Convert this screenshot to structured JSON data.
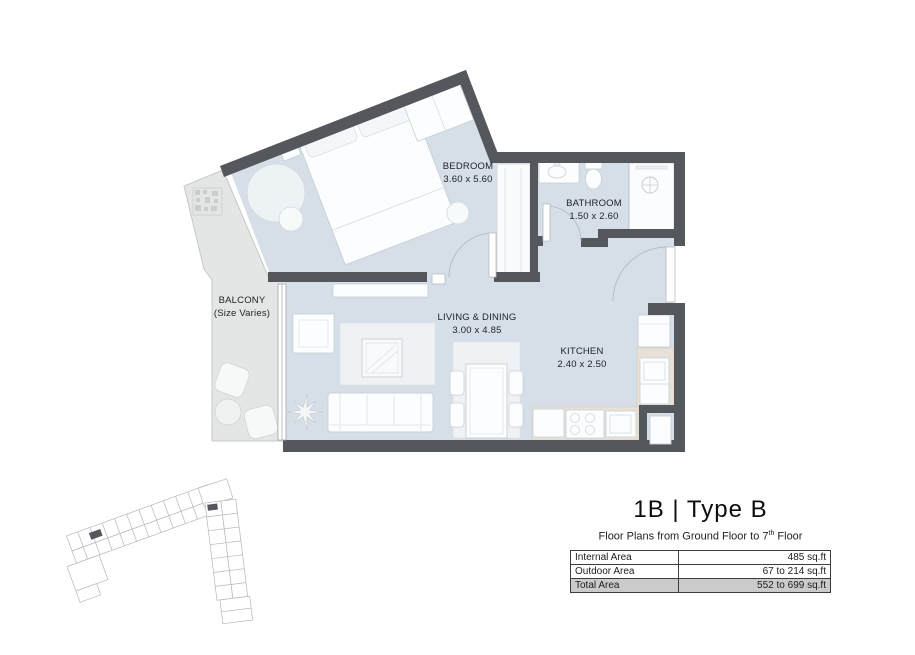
{
  "plan": {
    "rooms": {
      "bedroom": {
        "name": "BEDROOM",
        "dims": "3.60 x 5.60"
      },
      "bathroom": {
        "name": "BATHROOM",
        "dims": "1.50 x 2.60"
      },
      "living_dining": {
        "name": "LIVING & DINING",
        "dims": "3.00 x 4.85"
      },
      "kitchen": {
        "name": "KITCHEN",
        "dims": "2.40 x 2.50"
      },
      "balcony": {
        "name": "BALCONY",
        "dims": "(Size Varies)"
      }
    },
    "colors": {
      "wall": "#54575b",
      "floor": "#d6dfe7",
      "balcony": "#e4e5e5",
      "counter": "#e9e1d8",
      "furniture": "#fbfdfe",
      "total_row": "#cbcbcb"
    }
  },
  "title_block": {
    "title": "1B | Type B",
    "subtitle": {
      "prefix": "Floor Plans from Ground Floor to 7",
      "sup": "th",
      "suffix": " Floor"
    },
    "area_table": {
      "rows": [
        {
          "label": "Internal Area",
          "value": "485 sq.ft"
        },
        {
          "label": "Outdoor Area",
          "value": "67 to 214 sq.ft"
        },
        {
          "label": "Total Area",
          "value": "552 to 699 sq.ft"
        }
      ]
    }
  }
}
